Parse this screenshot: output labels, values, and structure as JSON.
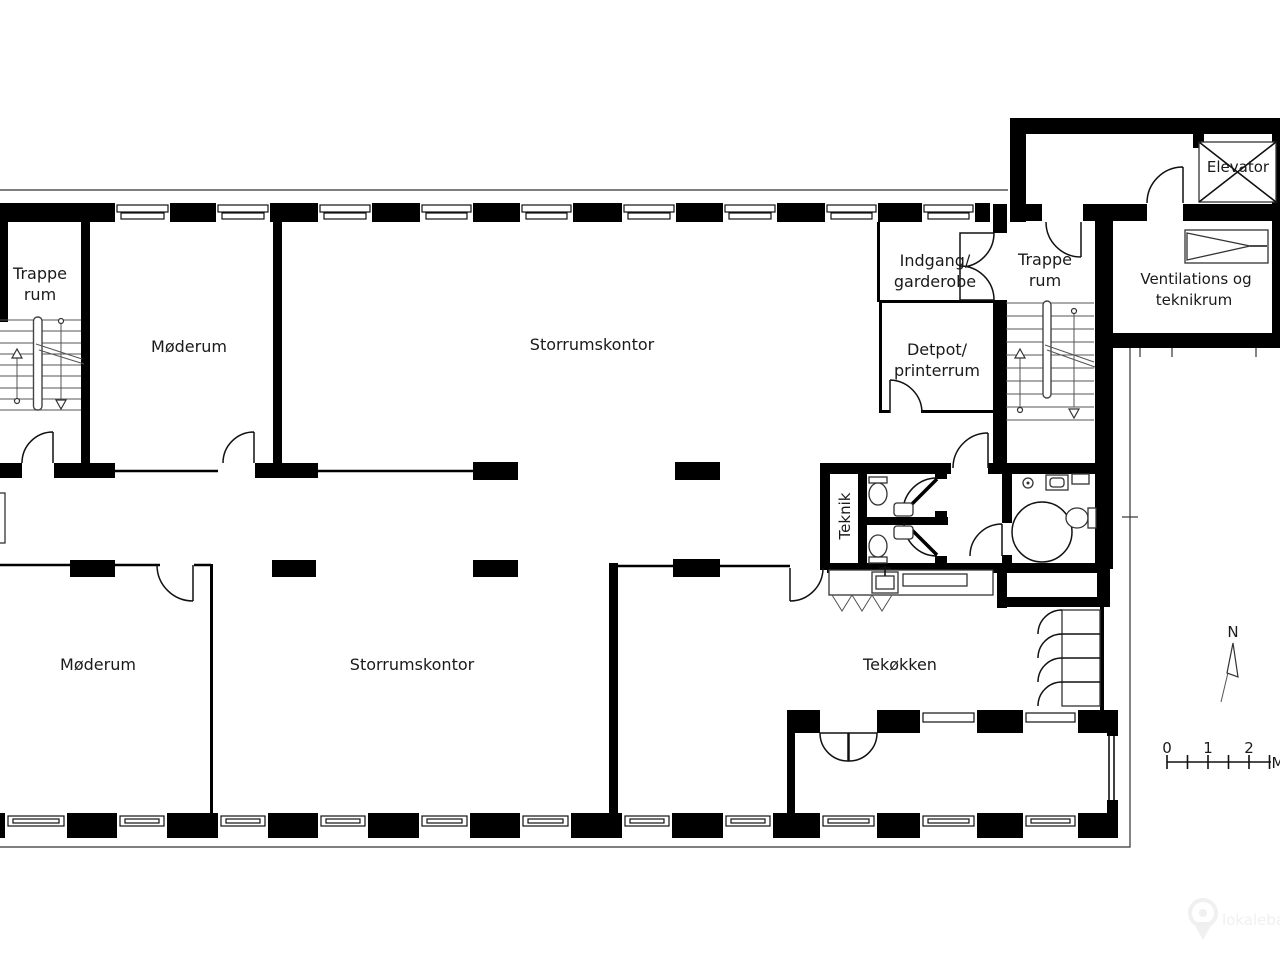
{
  "rooms": {
    "trappe_left": {
      "line1": "Trappe",
      "line2": "rum"
    },
    "moderum_top": {
      "label": "Møderum"
    },
    "storrumskontor_top": {
      "label": "Storrumskontor"
    },
    "indgang": {
      "line1": "Indgang/",
      "line2": "garderobe"
    },
    "trappe_right": {
      "line1": "Trappe",
      "line2": "rum"
    },
    "ventilation": {
      "line1": "Ventilations og",
      "line2": "teknikrum"
    },
    "elevator": {
      "label": "Elevator"
    },
    "detpot": {
      "line1": "Detpot/",
      "line2": "printerrum"
    },
    "teknik": {
      "label": "Teknik"
    },
    "moderum_bottom": {
      "label": "Møderum"
    },
    "storrumskontor_bottom": {
      "label": "Storrumskontor"
    },
    "tekokken": {
      "label": "Tekøkken"
    }
  },
  "compass": {
    "north_label": "N"
  },
  "scale_bar": {
    "tick0": "0",
    "tick1": "1",
    "tick2": "2",
    "unit": "M"
  },
  "watermark": {
    "text": "lokalebasen"
  },
  "colors": {
    "wall": "#000000",
    "line": "#111111",
    "stair_line": "#555555",
    "background": "#ffffff",
    "watermark": "#f0f0f0"
  }
}
